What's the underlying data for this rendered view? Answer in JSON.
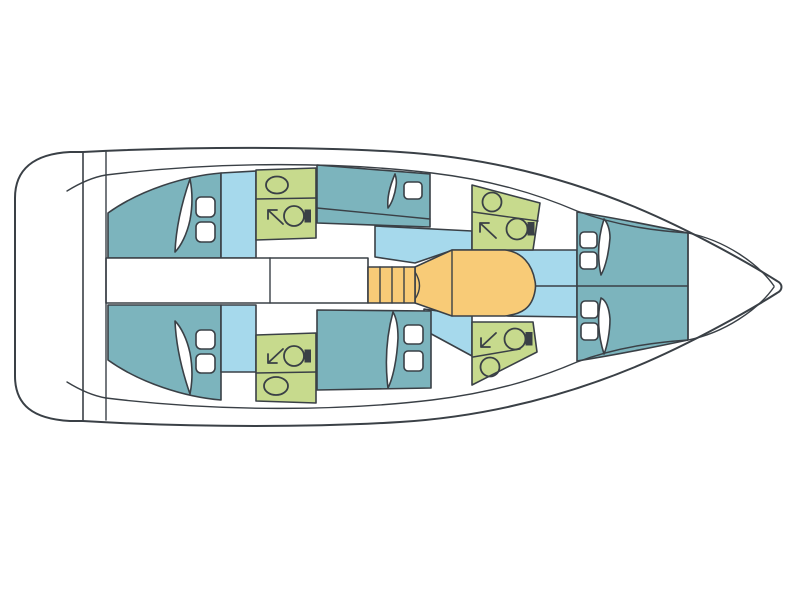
{
  "diagram": {
    "type": "yacht-floor-plan",
    "orientation": "bow-right-top-view",
    "colors": {
      "outline": "#3a4046",
      "white": "#ffffff",
      "cabin": "#7cb4bd",
      "floor": "#a6d9ec",
      "bathroom": "#c7da8d",
      "saloon": "#f8cb77"
    },
    "areas": {
      "stern_platform": "stern-swim-platform",
      "cockpit": "cockpit",
      "aft_cabin_port": "aft-double-cabin-port",
      "aft_cabin_starboard": "aft-double-cabin-starboard",
      "aft_head_port": "head-with-shower-port-aft",
      "aft_head_starboard": "head-with-shower-starboard-aft",
      "corridor": "central-corridor",
      "mid_cabin_port": "double-cabin-port-midship",
      "mid_cabin_starboard": "double-cabin-starboard-midship",
      "stairs": "companionway-stairs",
      "saloon_table": "saloon-table-area",
      "saloon_floor": "saloon-floor",
      "fwd_head_port": "head-with-shower-port-forward",
      "fwd_head_starboard": "head-with-shower-starboard-forward",
      "forward_cabin": "forward-v-berth-two-beds",
      "bow_locker": "bow-anchor-locker"
    },
    "fixture_icons": [
      "sink-icon",
      "toilet-icon",
      "shower-arrow-icon",
      "pillow",
      "blanket"
    ]
  }
}
